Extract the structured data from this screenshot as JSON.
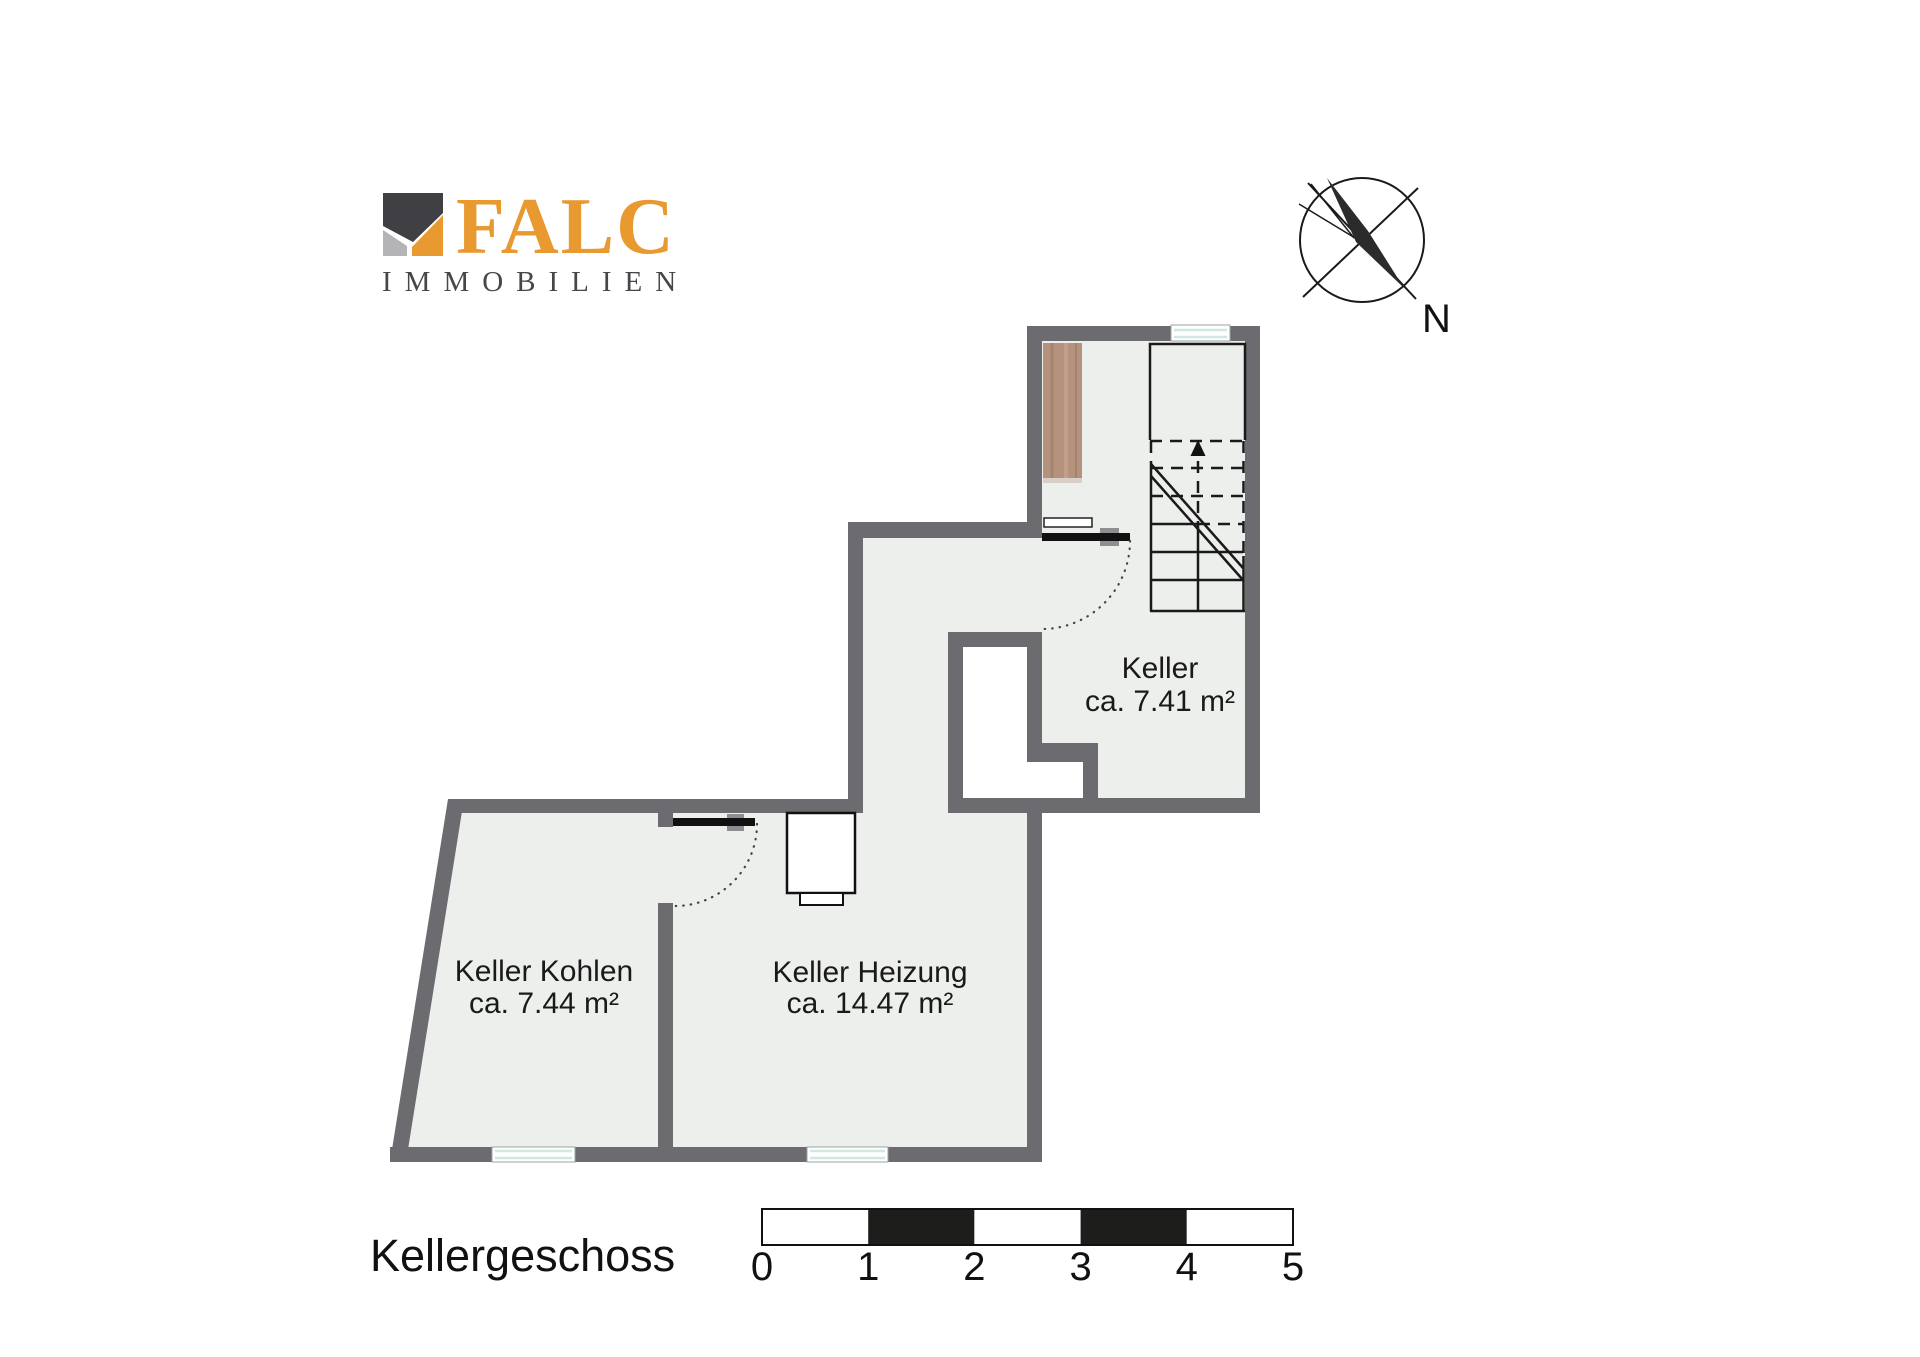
{
  "branding": {
    "logo_text": "FALC",
    "logo_subtext": "IMMOBILIEN"
  },
  "compass": {
    "north_label": "N"
  },
  "floor_label": "Kellergeschoss",
  "rooms": [
    {
      "name": "Keller",
      "area": "ca. 7.41 m²"
    },
    {
      "name": "Keller Kohlen",
      "area": "ca. 7.44 m²"
    },
    {
      "name": "Keller Heizung",
      "area": "ca. 14.47 m²"
    }
  ],
  "scale_bar": {
    "ticks": [
      "0",
      "1",
      "2",
      "3",
      "4",
      "5"
    ]
  },
  "icons": [
    "compass-rose-icon",
    "stairs-up-arrow-icon",
    "door-swing-icon",
    "window-icon",
    "heater-icon",
    "cabinet-icon"
  ],
  "colors": {
    "wall": "#6b6b70",
    "floor": "#edefec",
    "void": "#ffffff",
    "door": "#111111",
    "window_glass": "#cfe8e2",
    "cabinet_wood": "#b5927e",
    "logo_orange": "#e8992f",
    "logo_dark": "#3f3f44",
    "logo_gray": "#b4b4b6",
    "scale_black": "#1d1d1b"
  }
}
